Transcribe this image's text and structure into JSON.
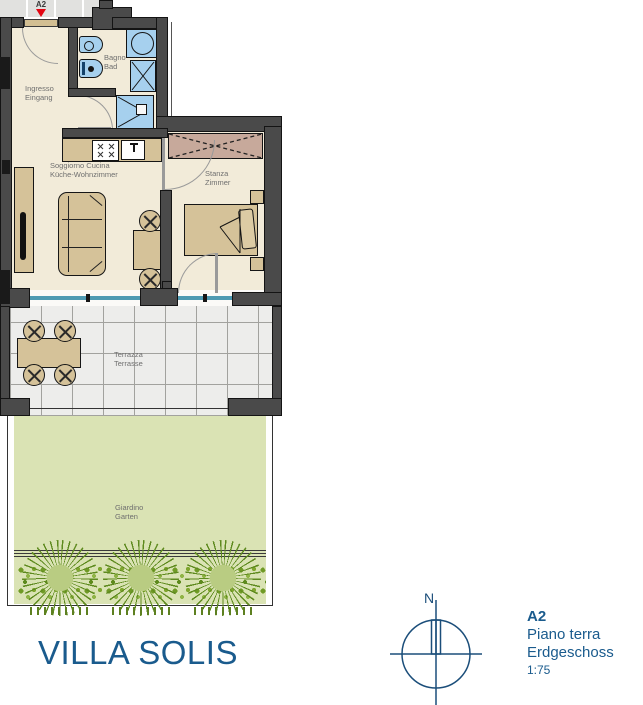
{
  "plan": {
    "unit_label": "A2",
    "rooms": {
      "ingresso": {
        "it": "Ingresso",
        "de": "Eingang"
      },
      "bagno": {
        "it": "Bagno",
        "de": "Bad"
      },
      "soggiorno": {
        "it": "Soggiorno Cucina",
        "de": "Küche-Wohnzimmer"
      },
      "stanza": {
        "it": "Stanza",
        "de": "Zimmer"
      },
      "terrazza": {
        "it": "Terrazza",
        "de": "Terrasse"
      },
      "giardino": {
        "it": "Giardino",
        "de": "Garten"
      }
    }
  },
  "footer": {
    "title": "VILLA SOLIS",
    "compass": {
      "north_label": "N"
    },
    "info": {
      "unit": "A2",
      "floor_it": "Piano terra",
      "floor_de": "Erdgeschoss",
      "scale": "1:75"
    }
  },
  "colors": {
    "brand_blue": "#1a5b8d",
    "wall_gray": "#4a4a4a",
    "floor_beige": "#f2ebd9",
    "fixture_blue": "#a6d0ee",
    "glass_teal": "#4e9ab2",
    "furniture_tan": "#d5c299",
    "wardrobe_mauve": "#c7a99b",
    "garden_green": "#dae3b4",
    "marker_red": "#e30613"
  }
}
